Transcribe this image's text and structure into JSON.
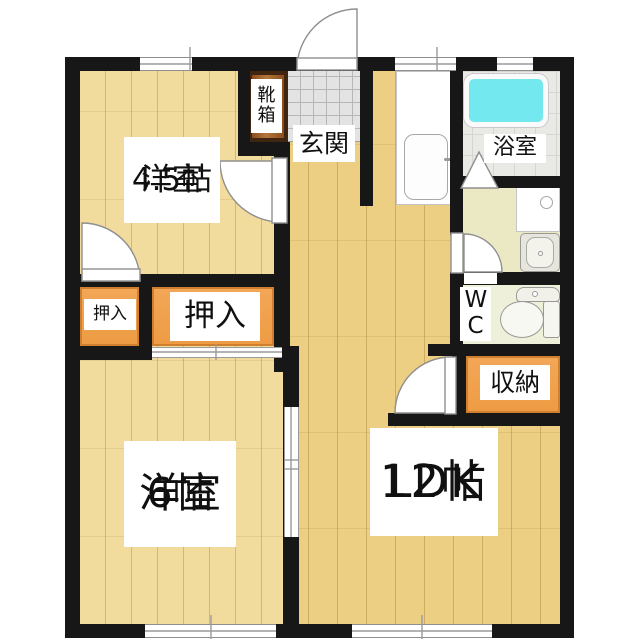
{
  "floorplan": {
    "type": "japanese-apartment-floorplan",
    "rooms": {
      "room45": {
        "name": "洋室",
        "size": "4.5帖"
      },
      "genkan": {
        "label": "玄関"
      },
      "shoe_cabinet": {
        "label": "靴箱"
      },
      "bathroom": {
        "label": "浴室"
      },
      "toilet": {
        "label": "WC"
      },
      "storage": {
        "label": "収納"
      },
      "closet_small": {
        "label": "押入"
      },
      "closet_large": {
        "label": "押入"
      },
      "room6": {
        "name": "洋室",
        "size": "6帖"
      },
      "ldk": {
        "name": "LDK",
        "size": "12帖"
      }
    },
    "fixtures": [
      "bathtub",
      "kitchen-sink",
      "washing-machine-pan",
      "vanity-sink",
      "toilet",
      "shoe-cabinet"
    ],
    "openings": [
      "entrance-door",
      "room45-door",
      "closet-small-door",
      "washroom-door",
      "ldk-hall-door",
      "bath-folding-door",
      "closet-sliding-door",
      "room6-ldk-sliding-door",
      "windows"
    ]
  },
  "colors": {
    "wall": "#171717",
    "wood-room": "#f1db9d",
    "wood-main": "#eccf83",
    "closet": "#ee9c44",
    "shoe": "#9a5a28",
    "tile": "#e3e3e3",
    "tub": "#74e8ef",
    "washroom": "#ebe9c4",
    "wc": "#eff0d9",
    "label-bg": "#ffffff",
    "ink": "#101010"
  }
}
